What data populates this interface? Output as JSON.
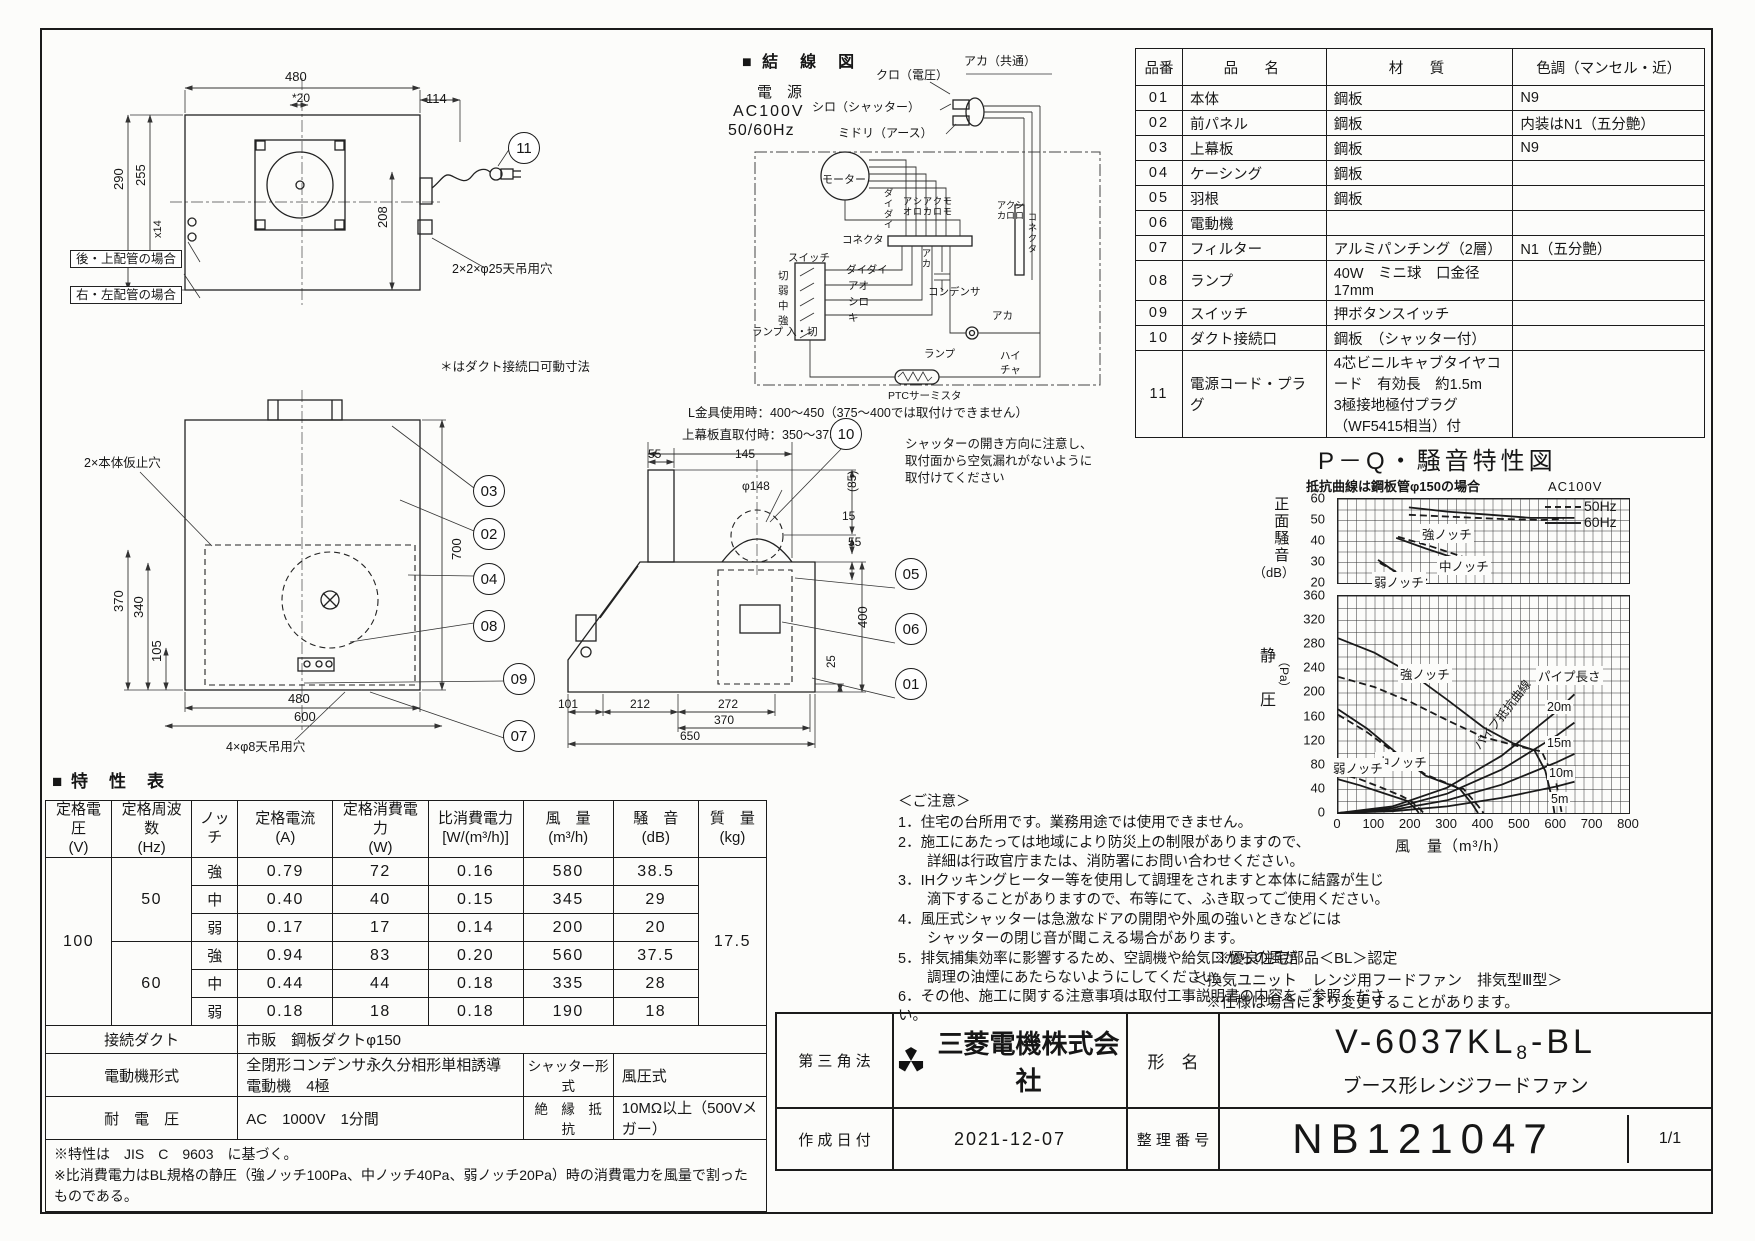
{
  "parts_table": {
    "headers": [
      "品番",
      "品　名",
      "材　質",
      "色調（マンセル・近）"
    ],
    "rows": [
      [
        "01",
        "本体",
        "鋼板",
        "N9"
      ],
      [
        "02",
        "前パネル",
        "鋼板",
        "内装はN1（五分艶）"
      ],
      [
        "03",
        "上幕板",
        "鋼板",
        "N9"
      ],
      [
        "04",
        "ケーシング",
        "鋼板",
        ""
      ],
      [
        "05",
        "羽根",
        "鋼板",
        ""
      ],
      [
        "06",
        "電動機",
        "",
        ""
      ],
      [
        "07",
        "フィルター",
        "アルミパンチング（2層）",
        "N1（五分艶）"
      ],
      [
        "08",
        "ランプ",
        "40W　ミニ球　口金径17mm",
        ""
      ],
      [
        "09",
        "スイッチ",
        "押ボタンスイッチ",
        ""
      ],
      [
        "10",
        "ダクト接続口",
        "鋼板　（シャッター付）",
        ""
      ],
      [
        "11",
        "電源コード・プラグ",
        "4芯ビニルキャブタイヤコード　有効長　約1.5m\n3極接地極付プラグ（WF5415相当）付",
        ""
      ]
    ]
  },
  "wiring": {
    "title": "■ 結　線　図",
    "power1": "電　源",
    "power2": "AC100V",
    "power3": "50/60Hz",
    "kuro": "クロ（電圧）",
    "shiro_shutter": "シロ（シャッター）",
    "midori": "ミドリ（アース）",
    "aka_common": "アカ（共通）",
    "motor": "モーター",
    "connector": "コネクタ",
    "connector_r": "コネクタ",
    "daidai_v": "ダイダイ",
    "pairs": [
      "アオ",
      "シロ",
      "アカ",
      "クロ",
      "モモ"
    ],
    "pairs_r": [
      "アカ",
      "クロ",
      "シロ"
    ],
    "daidai": "ダイダイ",
    "ao": "アオ",
    "shiro": "シロ",
    "ki": "キ",
    "aka_v": "アカ",
    "aka": "アカ",
    "condenser": "コンデンサ",
    "switch": "スイッチ",
    "sw_items": [
      "切",
      "弱",
      "中",
      "強"
    ],
    "lamp_sw": "ランプ\n入・切",
    "lamp": "ランプ",
    "hai": "ハイ",
    "cha": "チャ",
    "ptc": "PTCサーミスタ"
  },
  "views": {
    "top": {
      "d480": "480",
      "d20": "*20",
      "d114": "114",
      "d290": "290",
      "d255": "255",
      "dx14": "x14",
      "d208": "208",
      "rear": "後・上配管の場合",
      "rightleft": "右・左配管の場合",
      "holes": "2×2×φ25天吊用穴",
      "movable": "＊はダクト接続口可動寸法",
      "callout11": "11"
    },
    "front": {
      "d700": "700",
      "d370": "370",
      "d340": "340",
      "d105": "105",
      "d480": "480",
      "d600": "600",
      "holes": "4×φ8天吊用穴",
      "tack": "2×本体仮止穴",
      "c03": "03",
      "c02": "02",
      "c04": "04",
      "c08": "08",
      "c09": "09",
      "c07": "07"
    },
    "side": {
      "lkanagu": "L金具使用時：400～450（375～400では取付けできません）",
      "uwamaku": "上幕板直取付時：350～375",
      "d55t": "55",
      "d145": "145",
      "dphi148": "φ148",
      "d85": "(85)",
      "d15": "15",
      "d55r": "55",
      "d400": "400",
      "d25": "25",
      "d101": "101",
      "d212": "212",
      "d272": "272",
      "d370": "370",
      "d650": "650",
      "note": "シャッターの開き方向に注意し、\n取付面から空気漏れがないように\n取付けてください",
      "c10": "10",
      "c05": "05",
      "c06": "06",
      "c01": "01"
    }
  },
  "chart": {
    "title": "P－Q・騒音特性図",
    "subnote": "抵抗曲線は鋼板管φ150の場合",
    "voltage": "AC100V",
    "legend50": "50Hz",
    "legend60": "60Hz",
    "y1_label": "正面騒音",
    "y1_unit": "（dB）",
    "y2_label1": "静",
    "y2_label2": "圧",
    "y2_unit": "（Pa）",
    "x_label": "風　量（m³/h）",
    "ann_strong": "強ノッチ",
    "ann_mid": "中ノッチ",
    "ann_weak": "弱ノッチ",
    "ann_strong2": "強ノッチ",
    "ann_mid2": "中ノッチ",
    "ann_weak2": "弱ノッチ",
    "pipe_len": "パイプ長さ",
    "pipe_res": "パイプ抵抗曲線",
    "p20": "20m",
    "p15": "15m",
    "p10": "10m",
    "p5": "5m"
  },
  "chart_data": [
    {
      "type": "line",
      "title": "正面騒音 (dB) vs 風量",
      "xlim": [
        0,
        800
      ],
      "ylim": [
        20,
        60
      ],
      "xticks": [],
      "yticks": [
        "60",
        "50",
        "40",
        "30",
        "20"
      ],
      "series": [
        {
          "name": "強ノッチ 60Hz",
          "style": "solid",
          "points": [
            [
              195,
              56
            ],
            [
              300,
              54
            ],
            [
              420,
              52.5
            ],
            [
              530,
              51
            ],
            [
              650,
              51
            ]
          ]
        },
        {
          "name": "強ノッチ 50Hz",
          "style": "dashed",
          "points": [
            [
              195,
              52.5
            ],
            [
              320,
              51.5
            ],
            [
              450,
              50.5
            ],
            [
              560,
              50
            ],
            [
              620,
              50.5
            ]
          ]
        },
        {
          "name": "中ノッチ 60Hz",
          "style": "solid",
          "points": [
            [
              160,
              41.5
            ],
            [
              240,
              36.5
            ],
            [
              345,
              30.5
            ]
          ]
        },
        {
          "name": "中ノッチ 50Hz",
          "style": "dashed",
          "points": [
            [
              165,
              42
            ],
            [
              255,
              37.5
            ],
            [
              360,
              31.5
            ]
          ]
        },
        {
          "name": "弱ノッチ 60Hz",
          "style": "solid",
          "points": [
            [
              110,
              31
            ],
            [
              160,
              25
            ],
            [
              230,
              21
            ]
          ]
        },
        {
          "name": "弱ノッチ 50Hz",
          "style": "dashed",
          "points": [
            [
              115,
              29.5
            ],
            [
              175,
              24
            ],
            [
              245,
              21.5
            ]
          ]
        }
      ]
    },
    {
      "type": "line",
      "title": "静圧 (Pa) vs 風量 (m³/h)",
      "xlim": [
        0,
        800
      ],
      "ylim": [
        0,
        360
      ],
      "xticks": [
        "0",
        "100",
        "200",
        "300",
        "400",
        "500",
        "600",
        "700",
        "800"
      ],
      "yticks": [
        "360",
        "320",
        "280",
        "240",
        "200",
        "160",
        "120",
        "80",
        "40",
        "0"
      ],
      "series": [
        {
          "name": "強ノッチ 60Hz",
          "style": "solid",
          "points": [
            [
              0,
              290
            ],
            [
              100,
              266
            ],
            [
              200,
              232
            ],
            [
              300,
              188
            ],
            [
              400,
              142
            ],
            [
              480,
              116
            ],
            [
              540,
              104
            ],
            [
              570,
              70
            ],
            [
              590,
              20
            ],
            [
              595,
              0
            ]
          ]
        },
        {
          "name": "強ノッチ 50Hz",
          "style": "dashed",
          "points": [
            [
              0,
              226
            ],
            [
              100,
              209
            ],
            [
              200,
              184
            ],
            [
              300,
              154
            ],
            [
              400,
              126
            ],
            [
              500,
              110
            ],
            [
              560,
              102
            ],
            [
              600,
              50
            ],
            [
              615,
              0
            ]
          ]
        },
        {
          "name": "中ノッチ 60Hz",
          "style": "solid",
          "points": [
            [
              0,
              172
            ],
            [
              80,
              140
            ],
            [
              160,
              100
            ],
            [
              240,
              62
            ],
            [
              320,
              44
            ],
            [
              335,
              40
            ],
            [
              370,
              14
            ],
            [
              385,
              0
            ]
          ]
        },
        {
          "name": "中ノッチ 50Hz",
          "style": "dashed",
          "points": [
            [
              0,
              163
            ],
            [
              80,
              134
            ],
            [
              160,
              98
            ],
            [
              240,
              64
            ],
            [
              330,
              42
            ],
            [
              345,
              40
            ],
            [
              385,
              12
            ],
            [
              400,
              0
            ]
          ]
        },
        {
          "name": "弱ノッチ 60Hz",
          "style": "solid",
          "points": [
            [
              0,
              56
            ],
            [
              60,
              46
            ],
            [
              120,
              34
            ],
            [
              170,
              24
            ],
            [
              190,
              20
            ],
            [
              215,
              6
            ],
            [
              222,
              0
            ]
          ]
        },
        {
          "name": "弱ノッチ 50Hz",
          "style": "dashed",
          "points": [
            [
              0,
              66
            ],
            [
              60,
              56
            ],
            [
              120,
              42
            ],
            [
              175,
              28
            ],
            [
              200,
              20
            ],
            [
              228,
              5
            ],
            [
              235,
              0
            ]
          ]
        },
        {
          "name": "パイプ抵抗 20m",
          "style": "solid",
          "points": [
            [
              0,
              0
            ],
            [
              150,
              11
            ],
            [
              300,
              42
            ],
            [
              450,
              95
            ],
            [
              600,
              168
            ],
            [
              650,
              197
            ]
          ]
        },
        {
          "name": "パイプ抵抗 15m",
          "style": "solid",
          "points": [
            [
              0,
              0
            ],
            [
              150,
              8
            ],
            [
              300,
              32
            ],
            [
              450,
              72
            ],
            [
              600,
              128
            ],
            [
              650,
              150
            ]
          ]
        },
        {
          "name": "パイプ抵抗 10m",
          "style": "solid",
          "points": [
            [
              0,
              0
            ],
            [
              150,
              5
            ],
            [
              300,
              21
            ],
            [
              450,
              47
            ],
            [
              600,
              84
            ],
            [
              650,
              98
            ]
          ]
        },
        {
          "name": "パイプ抵抗 5m",
          "style": "solid",
          "points": [
            [
              0,
              0
            ],
            [
              150,
              3
            ],
            [
              300,
              11
            ],
            [
              450,
              25
            ],
            [
              600,
              44
            ],
            [
              650,
              52
            ]
          ]
        }
      ]
    }
  ],
  "spec_table": {
    "title": "■ 特　性　表",
    "headers": [
      "定格電圧\n(V)",
      "定格周波数\n(Hz)",
      "ノッチ",
      "定格電流\n(A)",
      "定格消費電力\n(W)",
      "比消費電力\n[W/(m³/h)]",
      "風　量\n(m³/h)",
      "騒　音\n(dB)",
      "質　量\n(kg)"
    ],
    "voltage": "100",
    "freq50": "50",
    "freq60": "60",
    "mass": "17.5",
    "rows": [
      [
        "強",
        "0.79",
        "72",
        "0.16",
        "580",
        "38.5"
      ],
      [
        "中",
        "0.40",
        "40",
        "0.15",
        "345",
        "29"
      ],
      [
        "弱",
        "0.17",
        "17",
        "0.14",
        "200",
        "20"
      ],
      [
        "強",
        "0.94",
        "83",
        "0.20",
        "560",
        "37.5"
      ],
      [
        "中",
        "0.44",
        "44",
        "0.18",
        "335",
        "28"
      ],
      [
        "弱",
        "0.18",
        "18",
        "0.18",
        "190",
        "18"
      ]
    ],
    "duct_label": "接続ダクト",
    "duct_value": "市販　鋼板ダクトφ150",
    "motor_label": "電動機形式",
    "motor_value": "全閉形コンデンサ永久分相形単相誘導電動機　4極",
    "shutter_label": "シャッター形式",
    "shutter_value": "風圧式",
    "withstand_label": "耐　電　圧",
    "withstand_value": "AC　1000V　1分間",
    "insul_label": "絶　縁　抵　抗",
    "insul_value": "10MΩ以上（500Vメガー）",
    "footnotes": "※特性は　JIS　C　9603　に基づく。\n※比消費電力はBL規格の静圧（強ノッチ100Pa、中ノッチ40Pa、弱ノッチ20Pa）時の消費電力を風量で割ったものである。"
  },
  "notes": {
    "header": "＜ご注意＞",
    "items": [
      "1．住宅の台所用です。業務用途では使用できません。",
      "2．施工にあたっては地域により防災上の制限がありますので、\n　　詳細は行政官庁または、消防署にお問い合わせください。",
      "3．IHクッキングヒーター等を使用して調理をされますと本体に結露が生じ\n　　滴下することがありますので、布等にて、ふき取ってご使用ください。",
      "4．風圧式シャッターは急激なドアの開閉や外風の強いときなどには\n　　シャッターの閉じ音が聞こえる場合があります。",
      "5．排気捕集効率に影響するため、空調機や給気口からの風が\n　　調理の油煙にあたらないようにしてください。",
      "6．その他、施工に関する注意事項は取付工事説明書の内容をご参照ください。"
    ]
  },
  "bl": {
    "line1": "※優良住宅部品＜BL＞認定",
    "line2": "＜換気ユニット　レンジ用フードファン　排気型Ⅲ型＞",
    "line3": "※仕様は場合により変更することがあります。"
  },
  "title_block": {
    "method": "第 三 角 法",
    "company": "三菱電機株式会社",
    "model_label": "形　名",
    "model_prefix": "V-6037KL",
    "model_sub": "8",
    "model_suffix": "-BL",
    "model_desc": "ブース形レンジフードファン",
    "date_label": "作 成 日 付",
    "date": "2021-12-07",
    "number_label": "整 理 番 号",
    "number": "NB121047",
    "page": "1/1"
  }
}
